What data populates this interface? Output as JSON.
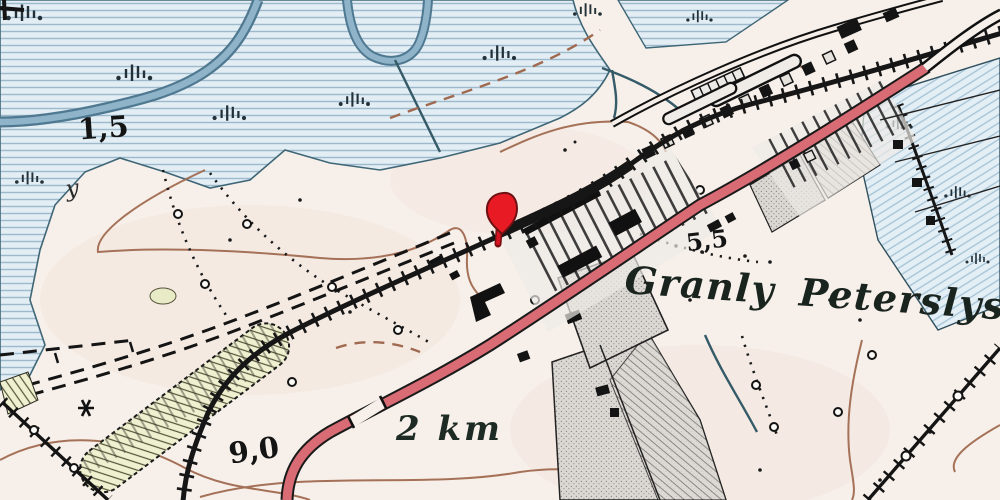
{
  "map": {
    "labels": {
      "place_name": "Granly Peterslyst",
      "distance": "2 km",
      "spot_height_nw": "1,5",
      "spot_height_center": "5,5",
      "spot_height_sw": "9,0",
      "truncated_label": "y"
    },
    "marker": {
      "icon": "location-pin-icon",
      "color": "#e81a23"
    },
    "colors": {
      "land": "#f7f0ea",
      "marsh_fill": "#e2edf4",
      "marsh_line": "#9db9cc",
      "river": "#7ea6bf",
      "railway": "#161616",
      "road_red": "#d96b74",
      "contour_brown": "#a06a50",
      "pit_green": "#eff0cf",
      "parcel_gray": "#dbd8d4"
    }
  }
}
